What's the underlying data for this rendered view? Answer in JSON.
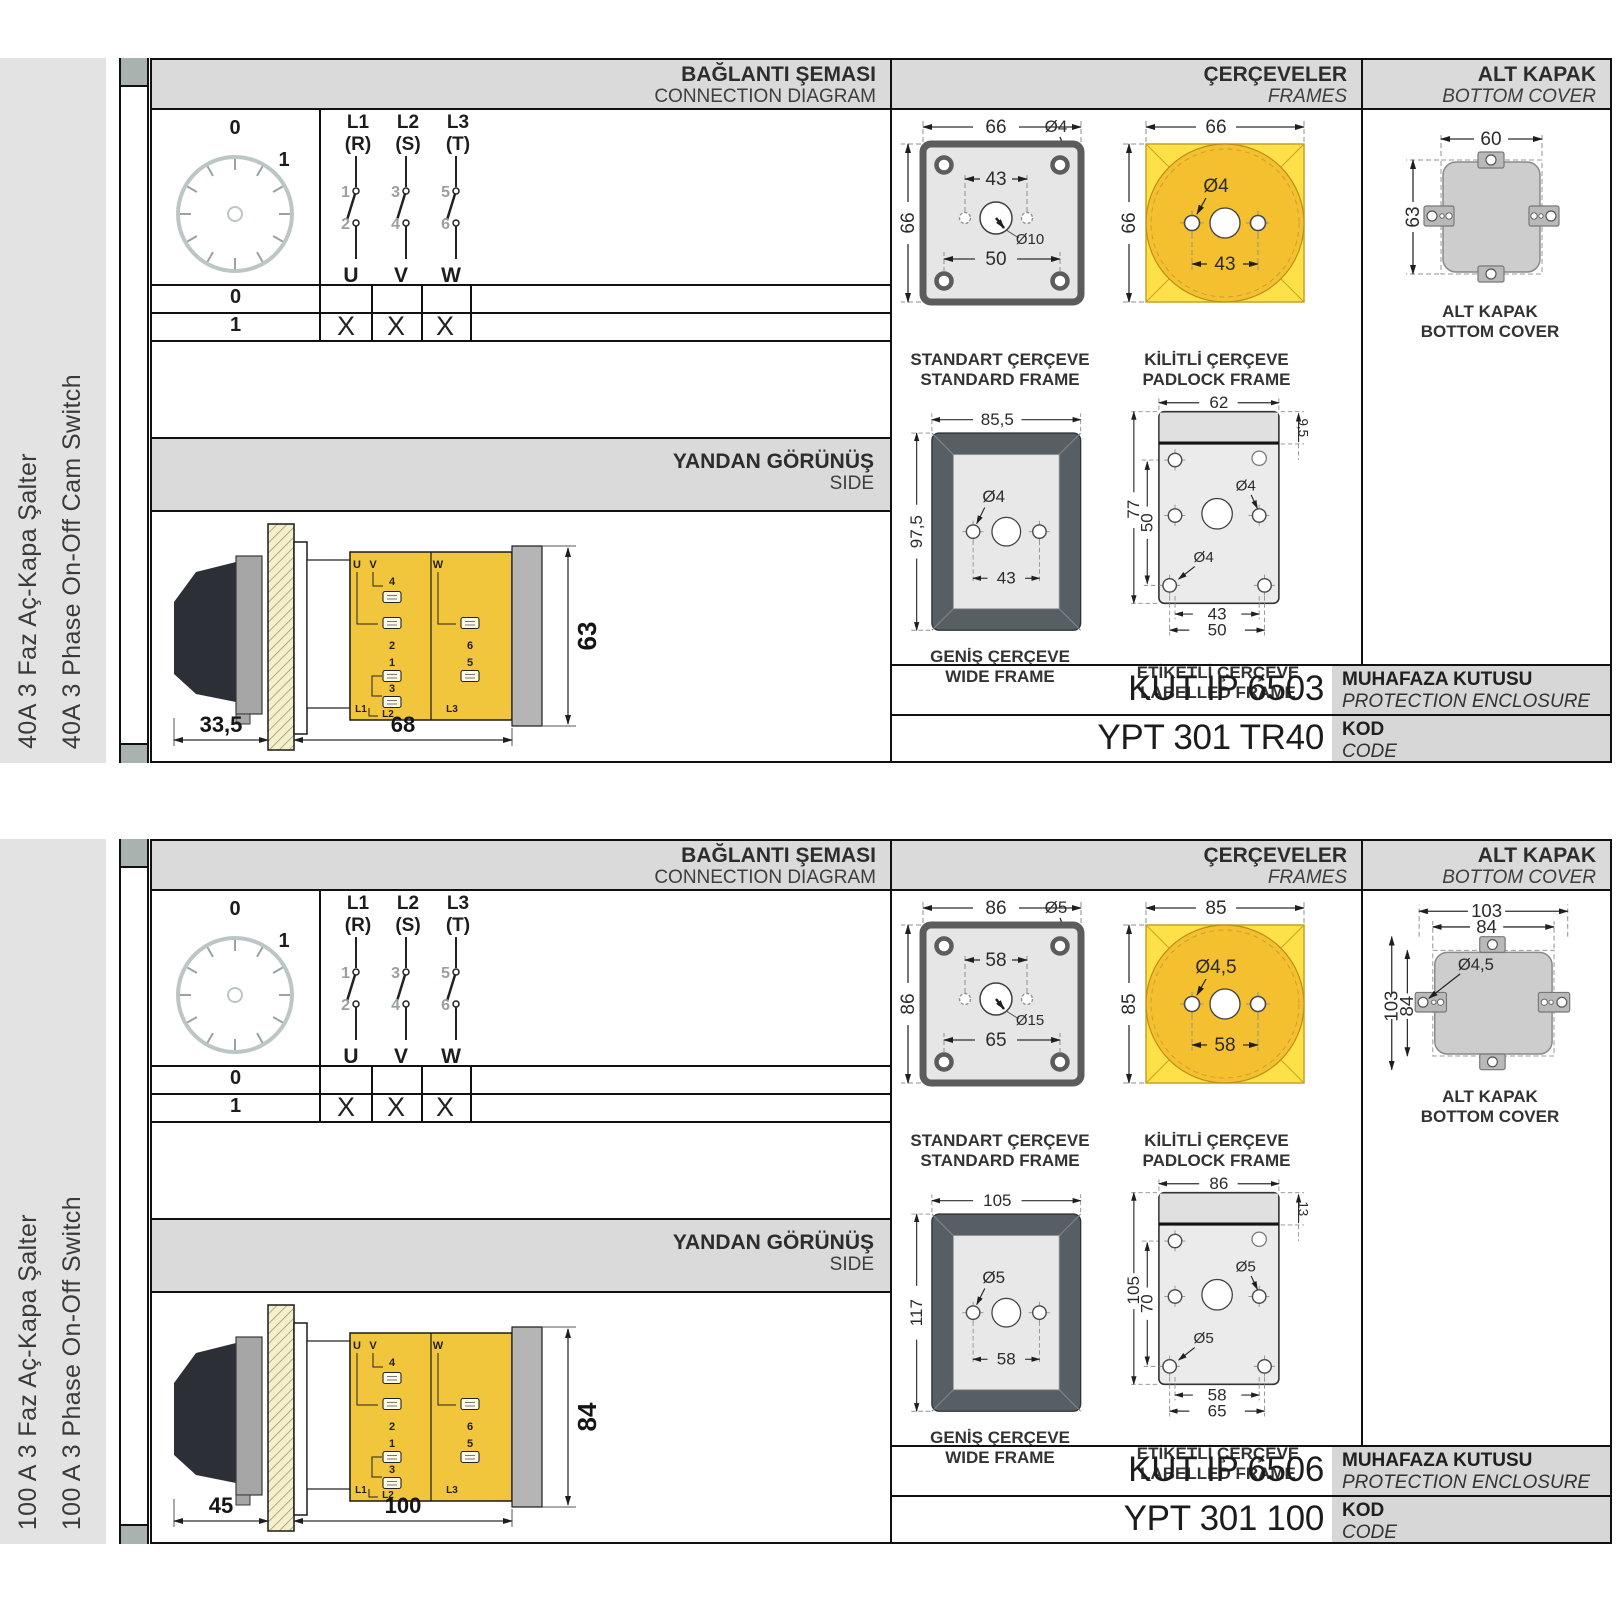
{
  "sections": [
    {
      "sidebar": {
        "tr": "40A 3 Faz Aç-Kapa Şalter",
        "en": "40A 3 Phase On-Off Cam Switch"
      },
      "header": {
        "diagram_tr": "BAĞLANTI ŞEMASI",
        "diagram_en": "CONNECTION DIAGRAM",
        "frames_tr": "ÇERÇEVELER",
        "frames_en": "FRAMES",
        "cover_tr": "ALT KAPAK",
        "cover_en": "BOTTOM COVER"
      },
      "dial": {
        "pos0": "0",
        "pos1": "1"
      },
      "switch": {
        "l1": "L1",
        "l1p": "(R)",
        "l2": "L2",
        "l2p": "(S)",
        "l3": "L3",
        "l3p": "(T)",
        "t1": "1",
        "t2": "2",
        "t3": "3",
        "t4": "4",
        "t5": "5",
        "t6": "6",
        "u": "U",
        "v": "V",
        "w": "W"
      },
      "table": {
        "row0": "0",
        "row1": "1",
        "x1": "X",
        "x2": "X",
        "x3": "X"
      },
      "side": {
        "band_tr": "YANDAN GÖRÜNÜŞ",
        "band_en": "SIDE",
        "dim_handle": "33,5",
        "dim_body": "68",
        "dim_height": "63",
        "labels": {
          "u": "U",
          "v": "V",
          "w": "W",
          "n1": "1",
          "n2": "2",
          "n3": "3",
          "n4": "4",
          "n5": "5",
          "n6": "6",
          "l1": "L1",
          "l2": "L2",
          "l3": "L3"
        }
      },
      "frames": {
        "standard": {
          "tr": "STANDART ÇERÇEVE",
          "en": "STANDARD FRAME",
          "dim_w": "66",
          "dim_h": "66",
          "dim_top": "43",
          "dim_bottom": "50",
          "dia_corner": "Ø4",
          "dia_center": "Ø10"
        },
        "padlock": {
          "tr": "KİLİTLİ ÇERÇEVE",
          "en": "PADLOCK FRAME",
          "dim_w": "66",
          "dim_h": "66",
          "dim_holes": "43",
          "dia_hole": "Ø4"
        },
        "wide": {
          "tr": "GENİŞ ÇERÇEVE",
          "en": "WIDE FRAME",
          "dim_w": "85,5",
          "dim_h": "97,5",
          "dim_holes": "43",
          "dia_hole": "Ø4"
        },
        "labelled": {
          "tr": "ETİKETLİ ÇERÇEVE",
          "en": "LABELLED FRAME",
          "dim_w": "62",
          "dim_h": "77",
          "dim_inner_h": "50",
          "dim_strip": "9,5",
          "dim_holes1": "43",
          "dim_holes2": "50",
          "dia_top": "Ø4",
          "dia_bottom": "Ø4"
        }
      },
      "cover": {
        "label_tr": "ALT KAPAK",
        "label_en": "BOTTOM COVER",
        "dim_w": "60",
        "dim_h": "63"
      },
      "codes": {
        "enclosure_value": "KUT IP 6503",
        "enclosure_tr": "MUHAFAZA KUTUSU",
        "enclosure_en": "PROTECTION ENCLOSURE",
        "code_value": "YPT 301 TR40",
        "code_tr": "KOD",
        "code_en": "CODE"
      }
    },
    {
      "sidebar": {
        "tr": "100 A 3 Faz Aç-Kapa Şalter",
        "en": "100 A 3 Phase On-Off Switch"
      },
      "header": {
        "diagram_tr": "BAĞLANTI ŞEMASI",
        "diagram_en": "CONNECTION DIAGRAM",
        "frames_tr": "ÇERÇEVELER",
        "frames_en": "FRAMES",
        "cover_tr": "ALT KAPAK",
        "cover_en": "BOTTOM COVER"
      },
      "dial": {
        "pos0": "0",
        "pos1": "1"
      },
      "switch": {
        "l1": "L1",
        "l1p": "(R)",
        "l2": "L2",
        "l2p": "(S)",
        "l3": "L3",
        "l3p": "(T)",
        "t1": "1",
        "t2": "2",
        "t3": "3",
        "t4": "4",
        "t5": "5",
        "t6": "6",
        "u": "U",
        "v": "V",
        "w": "W"
      },
      "table": {
        "row0": "0",
        "row1": "1",
        "x1": "X",
        "x2": "X",
        "x3": "X"
      },
      "side": {
        "band_tr": "YANDAN GÖRÜNÜŞ",
        "band_en": "SIDE",
        "dim_handle": "45",
        "dim_body": "100",
        "dim_height": "84",
        "labels": {
          "u": "U",
          "v": "V",
          "w": "W",
          "n1": "1",
          "n2": "2",
          "n3": "3",
          "n4": "4",
          "n5": "5",
          "n6": "6",
          "l1": "L1",
          "l2": "L2",
          "l3": "L3"
        }
      },
      "frames": {
        "standard": {
          "tr": "STANDART ÇERÇEVE",
          "en": "STANDARD FRAME",
          "dim_w": "86",
          "dim_h": "86",
          "dim_top": "58",
          "dim_bottom": "65",
          "dia_corner": "Ø5",
          "dia_center": "Ø15"
        },
        "padlock": {
          "tr": "KİLİTLİ ÇERÇEVE",
          "en": "PADLOCK FRAME",
          "dim_w": "85",
          "dim_h": "85",
          "dim_holes": "58",
          "dia_hole": "Ø4,5"
        },
        "wide": {
          "tr": "GENİŞ ÇERÇEVE",
          "en": "WIDE FRAME",
          "dim_w": "105",
          "dim_h": "117",
          "dim_holes": "58",
          "dia_hole": "Ø5"
        },
        "labelled": {
          "tr": "ETİKETLİ ÇERÇEVE",
          "en": "LABELLED FRAME",
          "dim_w": "86",
          "dim_h": "105",
          "dim_inner_h": "70",
          "dim_strip": "13",
          "dim_holes1": "58",
          "dim_holes2": "65",
          "dia_top": "Ø5",
          "dia_bottom": "Ø5"
        }
      },
      "cover": {
        "label_tr": "ALT KAPAK",
        "label_en": "BOTTOM COVER",
        "dim_w_outer": "103",
        "dim_w_inner": "84",
        "dim_h_outer": "103",
        "dim_h_inner": "84",
        "dia": "Ø4,5"
      },
      "codes": {
        "enclosure_value": "KUT IP 6506",
        "enclosure_tr": "MUHAFAZA KUTUSU",
        "enclosure_en": "PROTECTION ENCLOSURE",
        "code_value": "YPT 301 100",
        "code_tr": "KOD",
        "code_en": "CODE"
      }
    }
  ]
}
